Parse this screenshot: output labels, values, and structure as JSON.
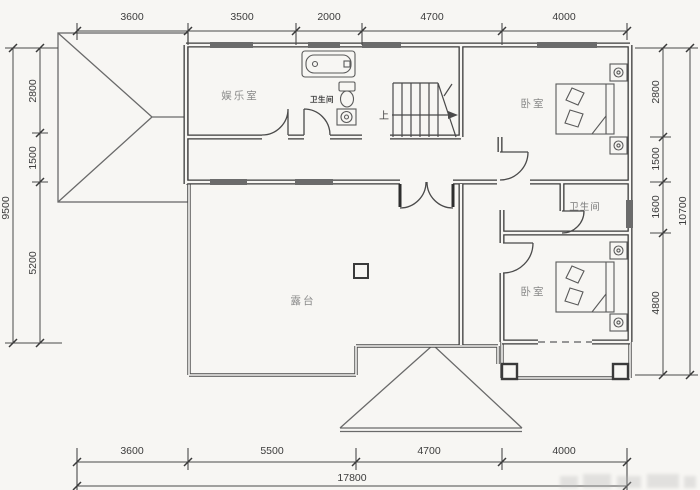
{
  "plan": {
    "dim_top": [
      "3600",
      "3500",
      "2000",
      "4700",
      "4000"
    ],
    "dim_bottom": [
      "3600",
      "5500",
      "4700",
      "4000"
    ],
    "dim_bottom_total": "17800",
    "dim_left": [
      "2800",
      "1500",
      "5200"
    ],
    "dim_left_total": "9500",
    "dim_right": [
      "2800",
      "1500",
      "1600",
      "4800"
    ],
    "dim_right_total": "10700",
    "rooms": {
      "entertainment_room": "娱乐室",
      "bathroom_top": "卫生间",
      "bedroom_top": "卧室",
      "bathroom_right": "卫生间",
      "bedroom_bottom": "卧室",
      "terrace": "露台"
    },
    "stair_up": "上"
  }
}
